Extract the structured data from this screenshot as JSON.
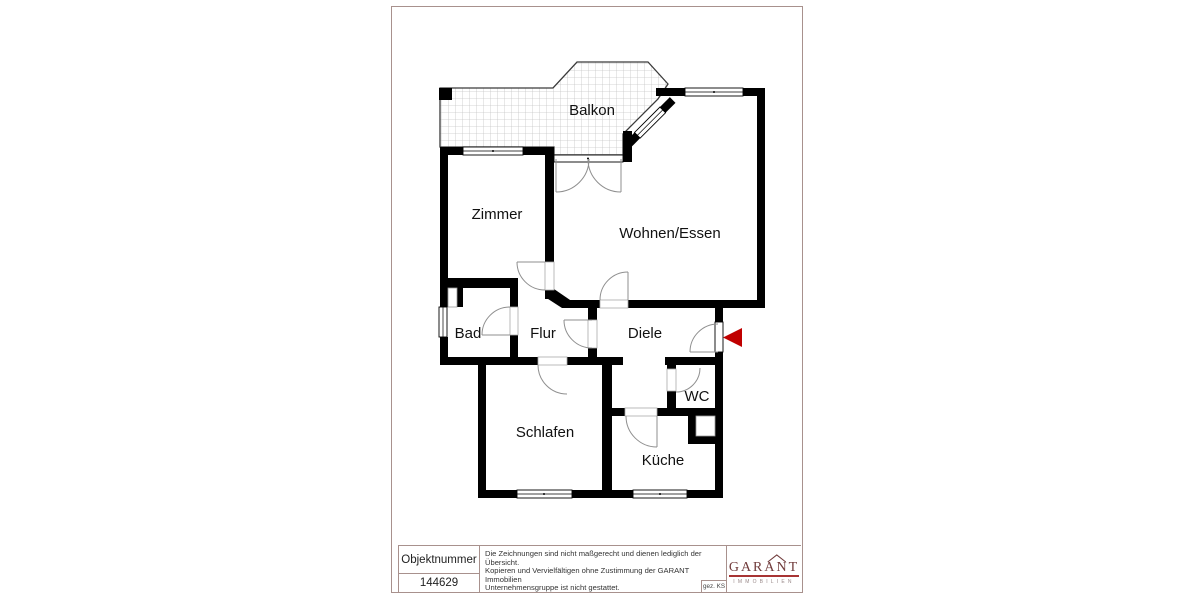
{
  "page": {
    "border_color": "#a8918d"
  },
  "floorplan": {
    "rooms": [
      {
        "id": "balkon",
        "label": "Balkon"
      },
      {
        "id": "zimmer",
        "label": "Zimmer"
      },
      {
        "id": "wohnen-essen",
        "label": "Wohnen/Essen"
      },
      {
        "id": "bad",
        "label": "Bad"
      },
      {
        "id": "flur",
        "label": "Flur"
      },
      {
        "id": "diele",
        "label": "Diele"
      },
      {
        "id": "wc",
        "label": "WC"
      },
      {
        "id": "schlafen",
        "label": "Schlafen"
      },
      {
        "id": "kueche",
        "label": "Küche"
      }
    ],
    "wall_color": "#000000",
    "entrance_arrow_color": "#c00000"
  },
  "title_block": {
    "object_number_label": "Objektnummer",
    "object_number_value": "144629",
    "disclaimer_lines": [
      "Die Zeichnungen sind nicht maßgerecht und dienen lediglich der Übersicht.",
      "Kopieren und Vervielfältigen ohne Zustimmung der GARANT Immobilien",
      "Unternehmensgruppe ist nicht gestattet."
    ],
    "signature": "gez. KS",
    "logo": {
      "name": "GARANT",
      "subtitle": "IMMOBILIEN",
      "color": "#713c3c",
      "line_color": "#a83434"
    }
  }
}
